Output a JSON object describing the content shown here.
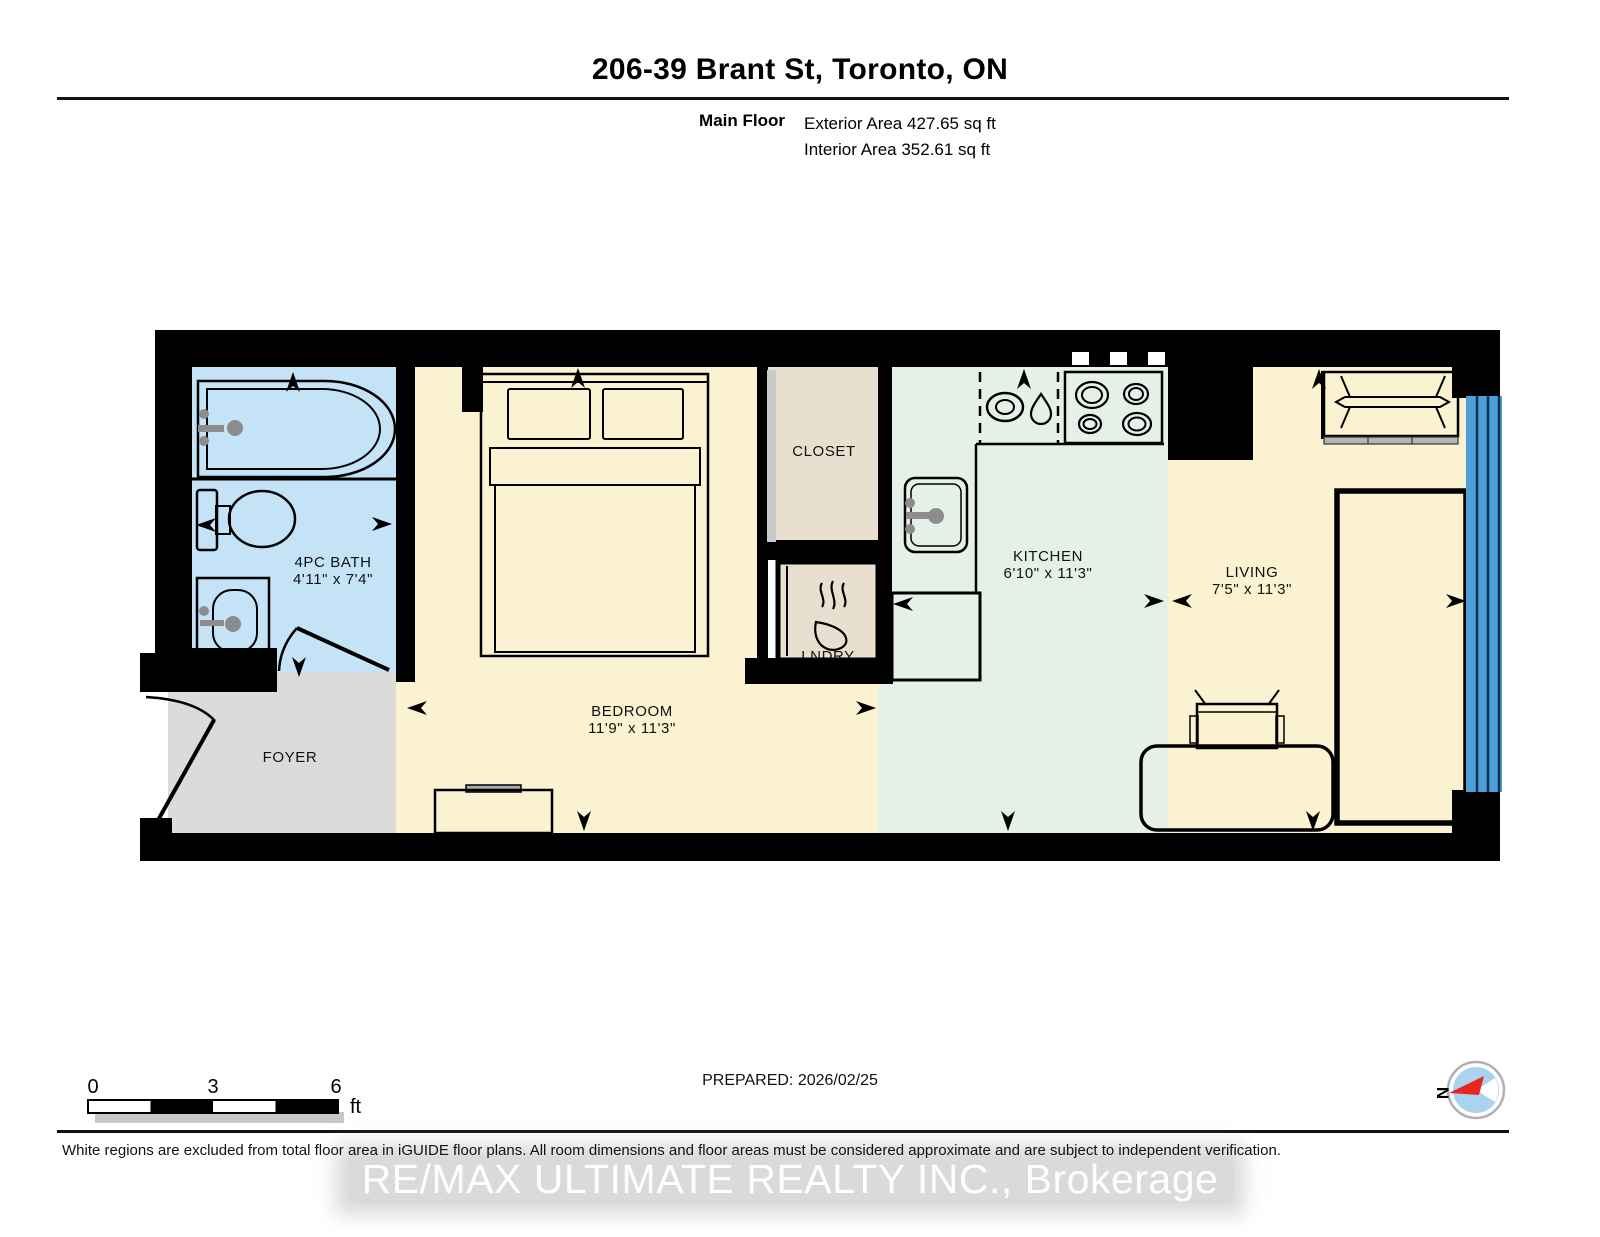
{
  "header": {
    "title": "206-39 Brant St, Toronto, ON",
    "floor_label": "Main Floor",
    "exterior_area": "Exterior Area 427.65 sq ft",
    "interior_area": "Interior Area 352.61 sq ft"
  },
  "rooms": {
    "bath": {
      "name": "4PC BATH",
      "dims": "4'11\" x 7'4\""
    },
    "foyer": {
      "name": "FOYER"
    },
    "bedroom": {
      "name": "BEDROOM",
      "dims": "11'9\" x 11'3\""
    },
    "closet": {
      "name": "CLOSET"
    },
    "laundry": {
      "name": "LNDRY"
    },
    "kitchen": {
      "name": "KITCHEN",
      "dims": "6'10\" x 11'3\""
    },
    "living": {
      "name": "LIVING",
      "dims": "7'5\" x 11'3\""
    }
  },
  "scale_bar": {
    "start": "0",
    "mid": "3",
    "end": "6",
    "unit": "ft"
  },
  "compass": {
    "north_label": "N"
  },
  "footer": {
    "prepared": "PREPARED: 2026/02/25",
    "disclaimer": "White regions are excluded from total floor area in iGUIDE floor plans. All room dimensions and floor areas must be considered approximate and are subject to independent verification.",
    "watermark": "RE/MAX ULTIMATE REALTY INC., Brokerage"
  },
  "colors": {
    "wall": "#000000",
    "bath_floor": "#C5E3F7",
    "cream_floor": "#FBF2D2",
    "kitchen_floor": "#E5F0E9",
    "closet_floor": "#E9DFCE",
    "foyer_floor": "#DBDBDB",
    "window": "#4C9FD7",
    "window_line": "#13314E",
    "compass_red": "#E8251F",
    "compass_blue": "#A9D3EE"
  }
}
